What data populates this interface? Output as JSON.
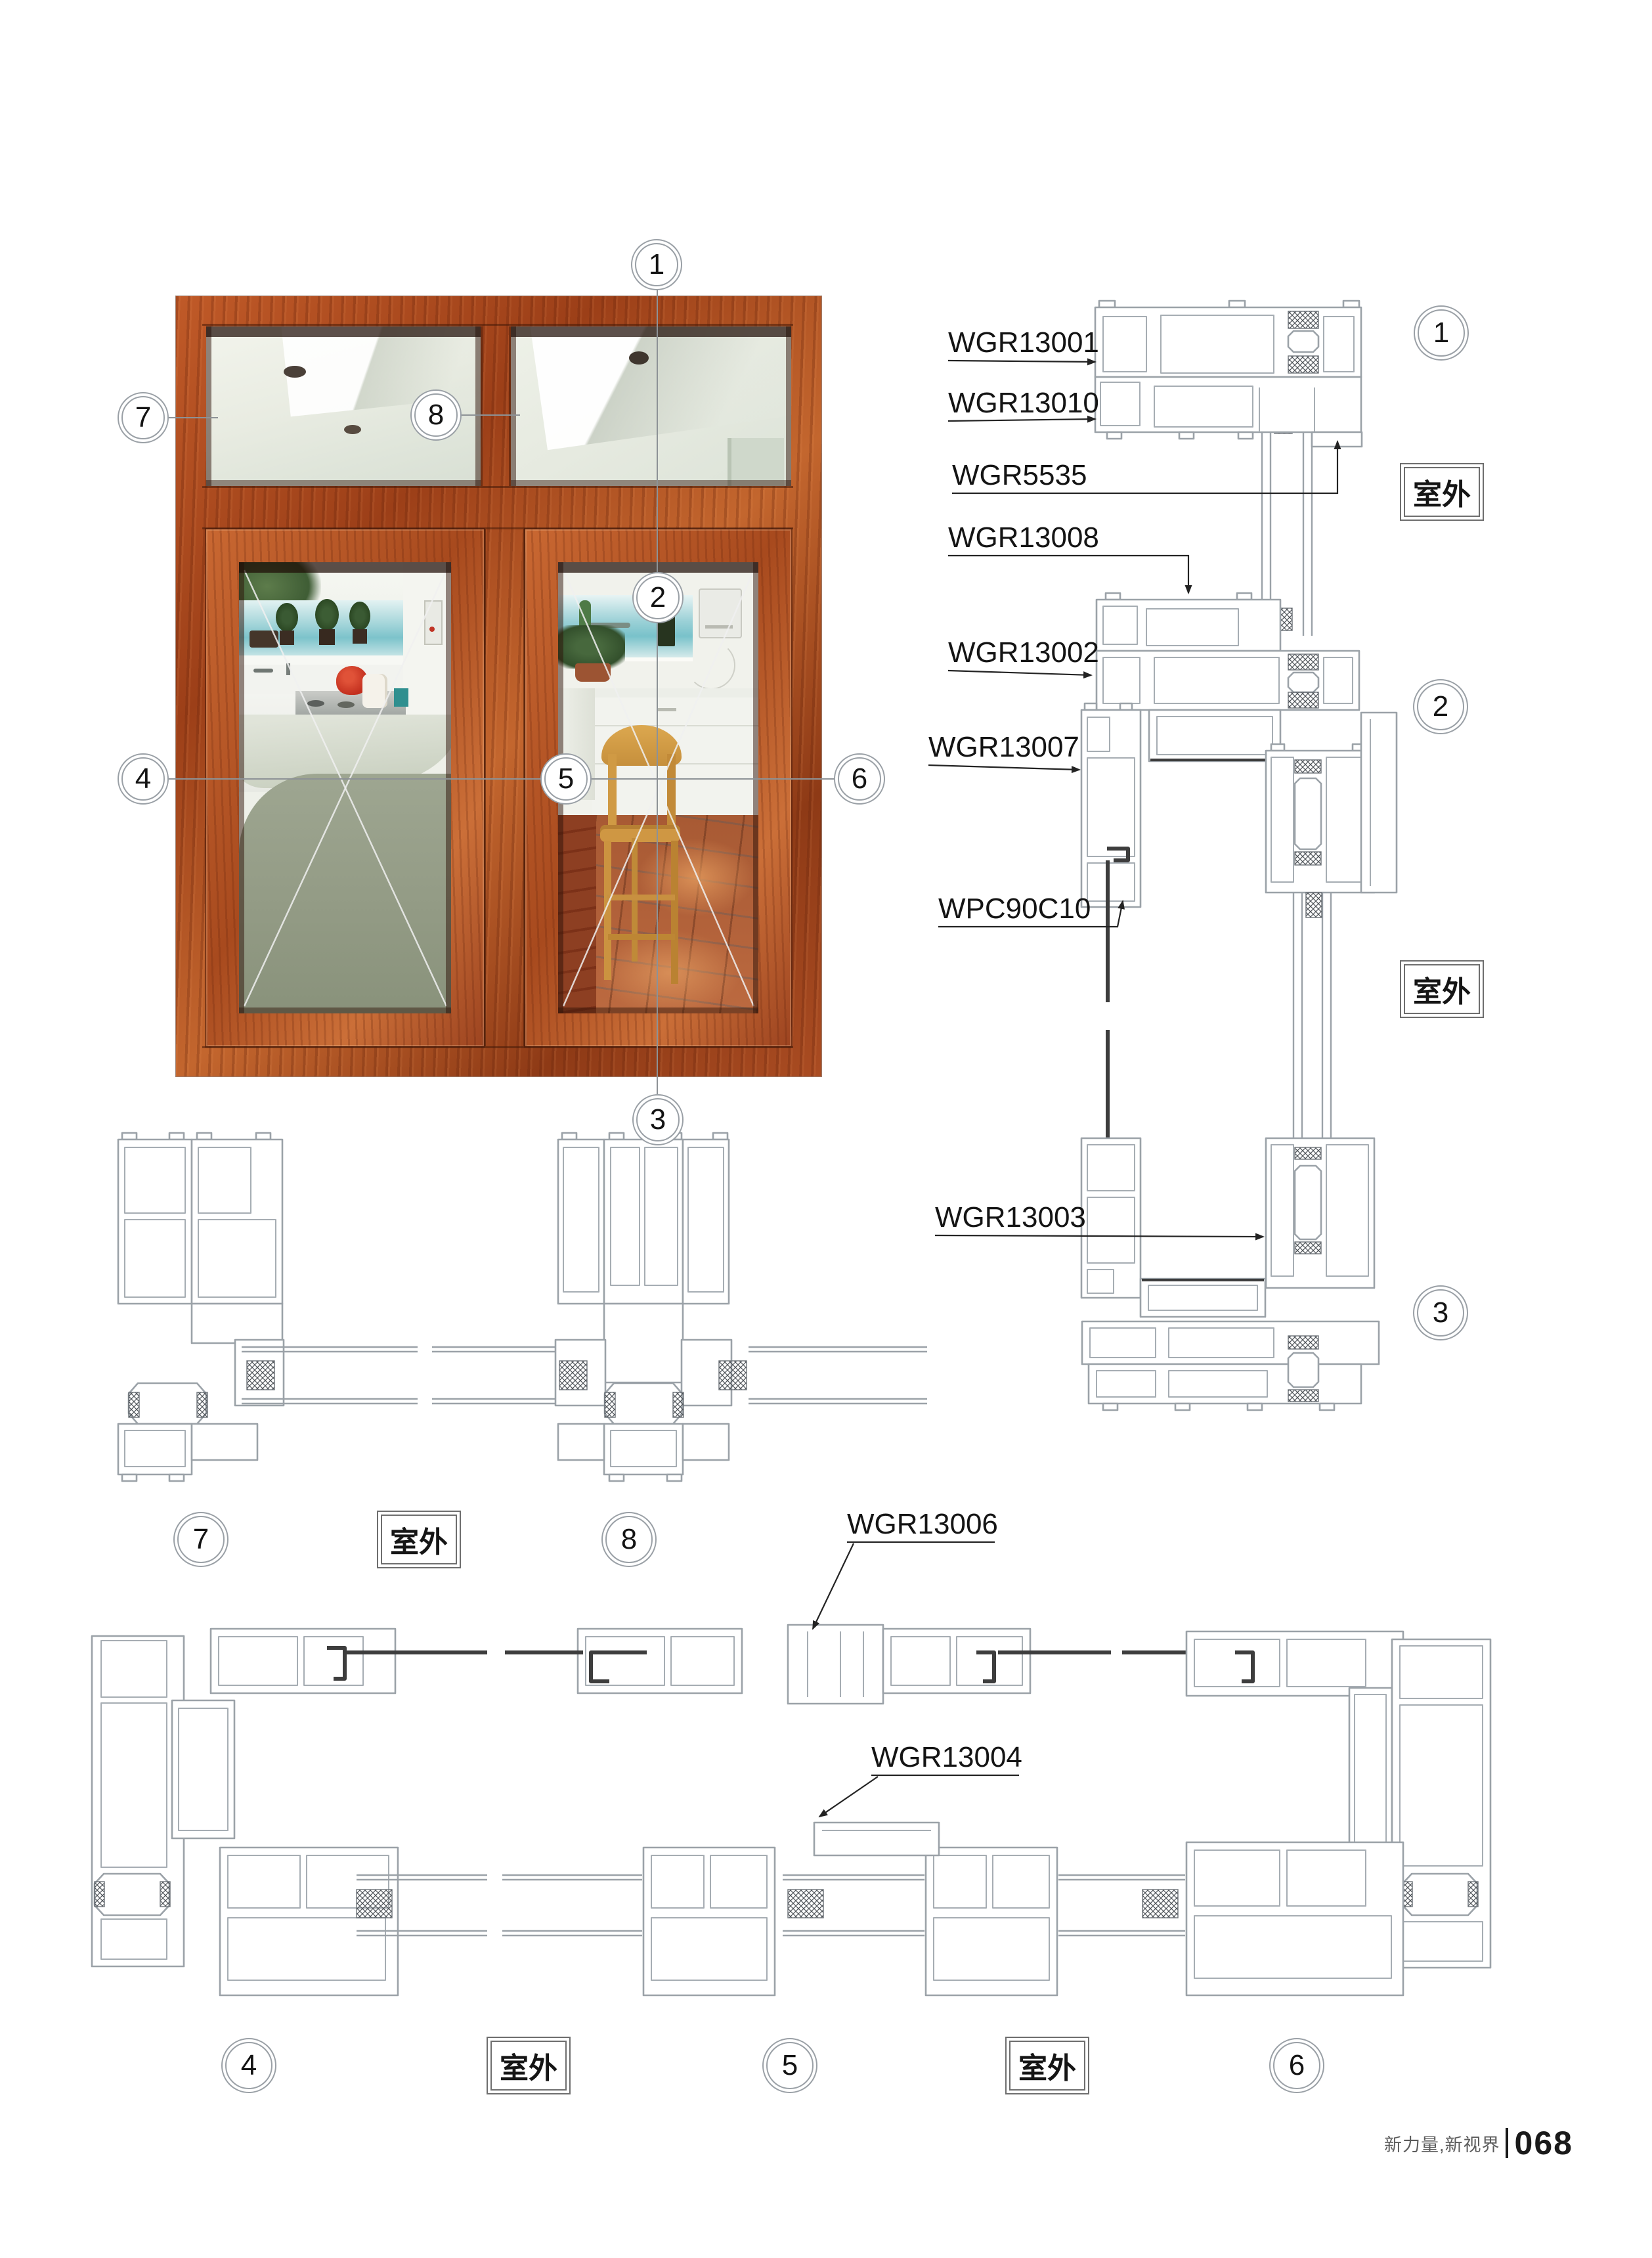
{
  "outdoor_label": "室外",
  "markers": {
    "m1": "1",
    "m2": "2",
    "m3": "3",
    "m4": "4",
    "m5": "5",
    "m6": "6",
    "m7": "7",
    "m8": "8"
  },
  "profile_labels": {
    "wgr13001": "WGR13001",
    "wgr13010": "WGR13010",
    "wgr5535": "WGR5535",
    "wgr13008": "WGR13008",
    "wgr13002": "WGR13002",
    "wgr13007": "WGR13007",
    "wpc90c10": "WPC90C10",
    "wgr13003": "WGR13003",
    "wgr13006": "WGR13006",
    "wgr13004": "WGR13004"
  },
  "footer": {
    "brand": "新力量,新视界",
    "page_number": "068"
  },
  "colors": {
    "wood_accent": "#a94a20",
    "drawing_line": "#9ba2a8",
    "dark_gasket": "#3d3d3d",
    "sea": "#8fccd4",
    "tile_floor": "#b4643c"
  }
}
